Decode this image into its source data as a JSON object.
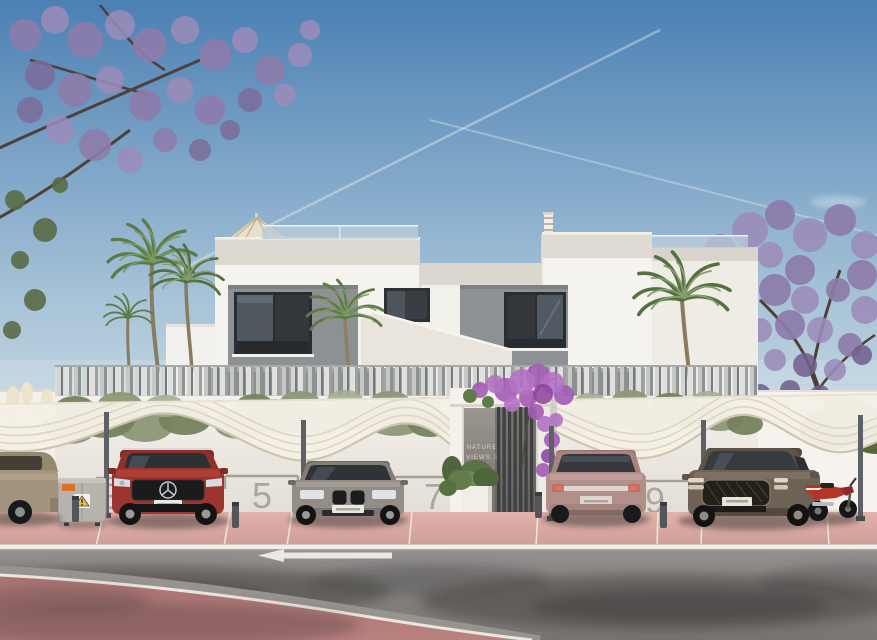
{
  "scene": {
    "type": "architectural-exterior-render",
    "description": "Front view of a modern white two-storey duplex villa with rooftop terraces, slatted privacy fence, wave-shaped carport canopies over numbered parking bays, palm and jacaranda trees, and an asphalt road in the foreground"
  },
  "signage": {
    "line1": "NATURE",
    "line2": "VIEWS 3"
  },
  "parking": {
    "numbers": [
      "3",
      "5",
      "7",
      "9"
    ]
  },
  "road": {
    "lane_arrow_direction": "left"
  },
  "vehicles": [
    "beige sedan (partial, left edge)",
    "red SUV",
    "grey sedan",
    "mauve SUV (rear view)",
    "bronze sedan",
    "red motorcycle"
  ],
  "colors": {
    "sky_top": "#4b80b3",
    "sky_horizon": "#c9d9e3",
    "facade_white": "#f5f3ef",
    "accent_panel_gray": "#8e9193",
    "window_glass": "#33373b",
    "fence_slat_gray": "#9b9e9f",
    "canopy_cream": "#f4f0e6",
    "sidewalk_pink": "#dfb3ab",
    "road_asphalt": "#8f8c89",
    "cycle_path_red": "#aa7374",
    "jacaranda_purple": "#8d7cab",
    "palm_green": "#5d7a49",
    "bougainvillea_magenta": "#a35cb5",
    "suv_red": "#9c352f",
    "sedan_gray": "#918b83",
    "suv_mauve": "#b08e89",
    "sedan_bronze": "#6e6156",
    "motorcycle_red": "#b23528"
  }
}
